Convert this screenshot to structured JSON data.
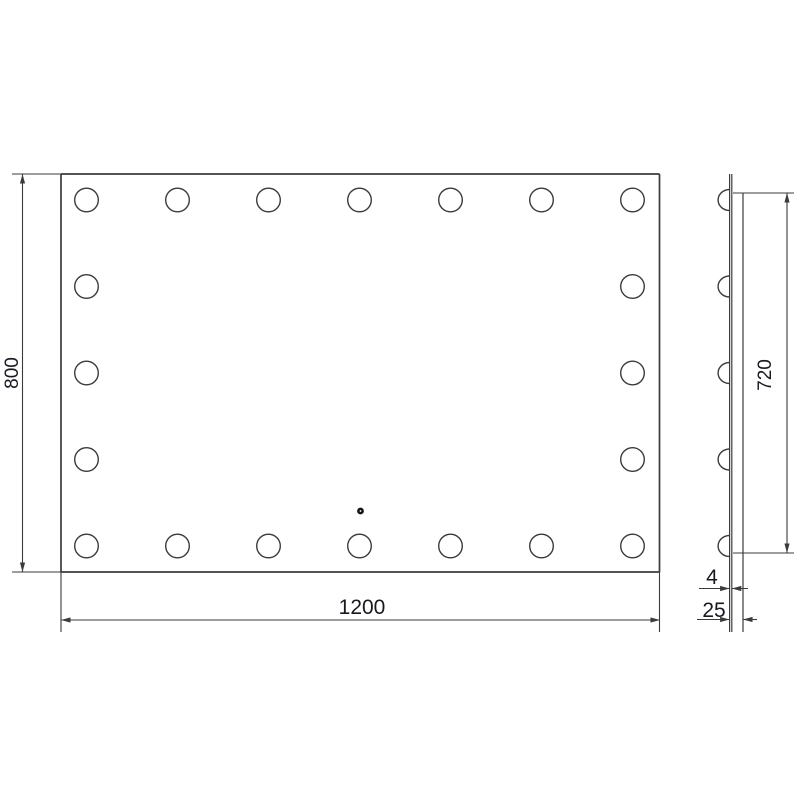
{
  "page": {
    "background": "#ffffff"
  },
  "drawing": {
    "kind": "technical-dimension-drawing",
    "views": [
      "front-view-mirror-with-bulbs",
      "side-profile-view"
    ],
    "labels": {
      "mirror_width_mm": "1200",
      "mirror_height_mm": "800",
      "lit_zone_height_mm": "720",
      "glass_thickness_mm": "4",
      "mount_depth_mm": "25"
    },
    "style": {
      "line_color": "#3b3b3b",
      "text_color": "#181820",
      "edge_stroke": 1.7,
      "thin_stroke": 1.1,
      "bulb_stroke": 1.4,
      "dim_font_px": 21,
      "dim_font_rotated_px": 19,
      "arrow_len": 9.5,
      "arrow_halfwidth": 2.6
    },
    "front_view": {
      "rect": {
        "left": 61,
        "top": 174,
        "right": 659.5,
        "bottom": 572
      },
      "edge_ext_left_x": 12,
      "edge_ext_bottom_y": 632,
      "bulb_radius": 11.8,
      "bulb_cols_x": [
        86.5,
        177.5,
        268.5,
        359.5,
        450.5,
        541.5,
        632.5
      ],
      "bulb_rows_y": [
        200,
        286.5,
        373,
        459.5,
        546
      ],
      "bulb_count": 20,
      "sensor_dot": {
        "cx": 360.5,
        "cy": 511,
        "r": 3.4,
        "hole_r": 0.9
      }
    },
    "side_view": {
      "glass_front_x": 729.6,
      "glass_back_x": 731.8,
      "panel_back_x": 743,
      "top_y": 174,
      "panel_top_y": 193,
      "ext_bottom_y": 632,
      "bulb_rx": 11.5,
      "bulb_ry": 10.5
    },
    "dimensions": {
      "height": {
        "line_x": 22.5,
        "from_y": 174,
        "to_y": 572,
        "label_x": 18,
        "label_y": 373
      },
      "width": {
        "line_y": 620,
        "from_x": 61,
        "to_x": 660,
        "label_x": 362,
        "label_y": 614
      },
      "lit_height": {
        "line_x": 787,
        "from_y": 193,
        "to_y": 553,
        "tick_from_x": 733,
        "tick_to_x": 794,
        "label_x": 771,
        "label_y": 375
      },
      "glass": {
        "line_y": 588.5,
        "tail_from_x": 699,
        "tip1_x": 729.6,
        "tip2_x": 731.8,
        "tail_to_x": 748,
        "label_x": 712,
        "label_y": 584
      },
      "depth": {
        "line_y": 619.5,
        "tail_from_x": 697,
        "tip1_x": 729.6,
        "tip2_x": 743,
        "tail_to_x": 757,
        "label_x": 714,
        "label_y": 617
      }
    }
  }
}
